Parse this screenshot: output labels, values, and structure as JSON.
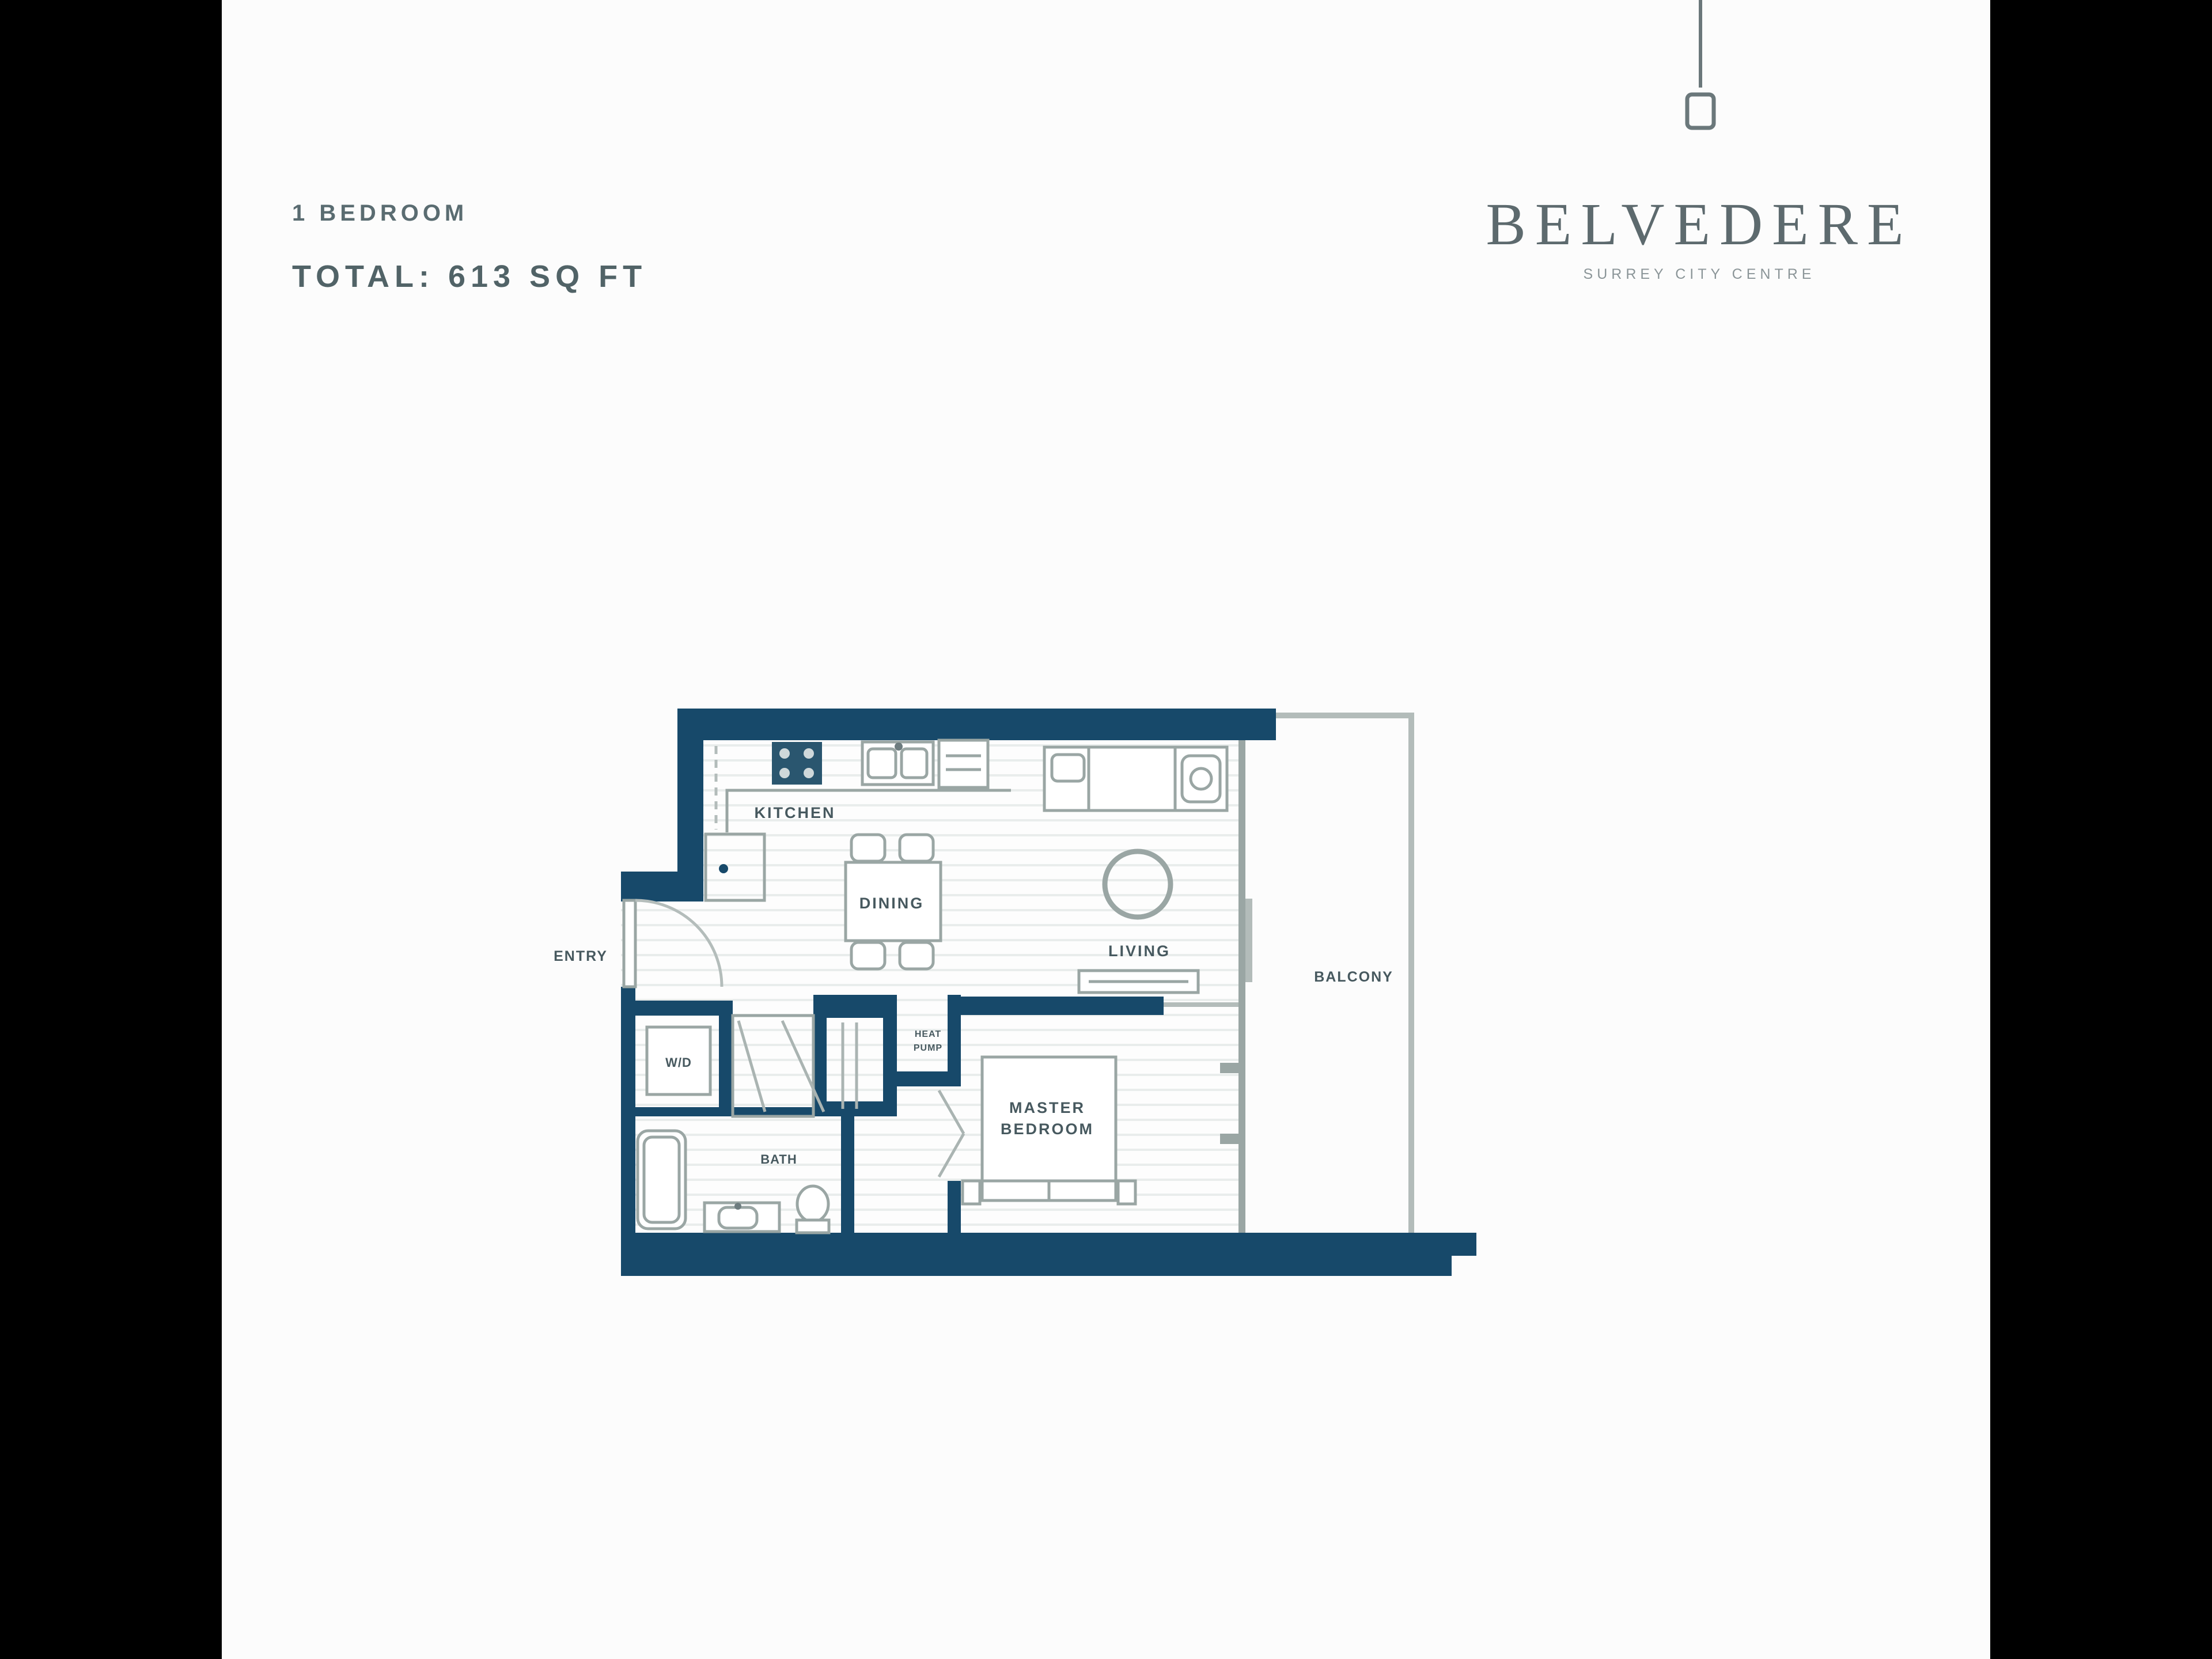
{
  "page": {
    "letterbox_color": "#000000",
    "background": "#fcfcfc"
  },
  "header": {
    "unit_type": "1 BEDROOM",
    "total_area": "TOTAL: 613 SQ FT"
  },
  "brand": {
    "name": "BELVEDERE",
    "tagline": "SURREY CITY CENTRE",
    "logo_mark": "pendant-line-icon"
  },
  "plan": {
    "wall_color": "#17496a",
    "line_color": "#9aa6a4",
    "label_color": "#47595f",
    "labels": {
      "kitchen": "KITCHEN",
      "dining": "DINING",
      "living": "LIVING",
      "entry": "ENTRY",
      "washer_dryer": "W/D",
      "bath": "BATH",
      "balcony": "BALCONY",
      "master_bedroom_lines": [
        "MASTER",
        "BEDROOM"
      ],
      "heat_pump_lines": [
        "HEAT",
        "PUMP"
      ]
    }
  }
}
